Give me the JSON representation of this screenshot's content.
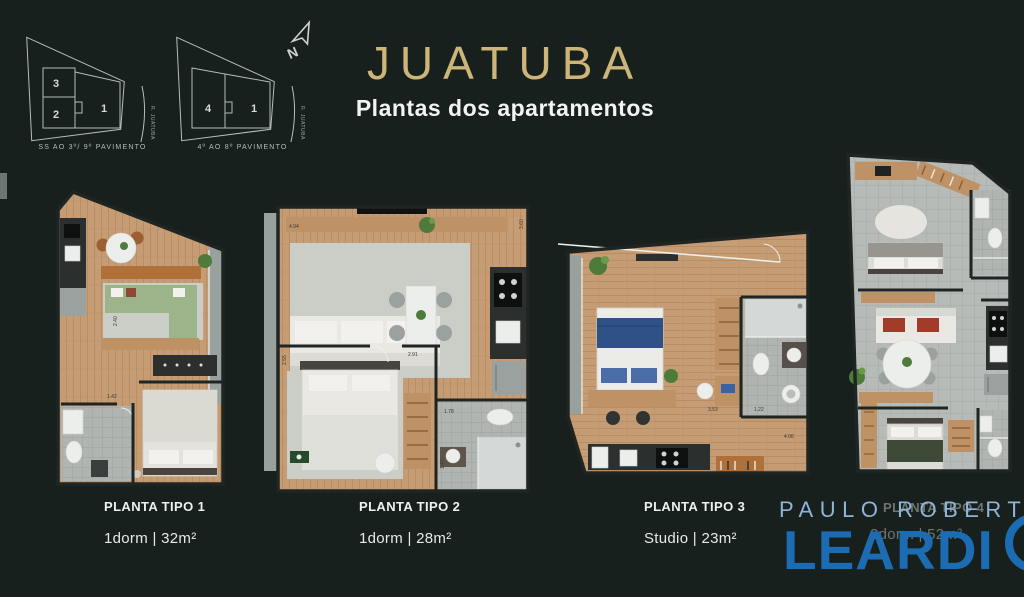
{
  "header": {
    "title": "JUATUBA",
    "subtitle": "Plantas dos apartamentos"
  },
  "north_label": "N",
  "site_plans": [
    {
      "units": [
        "3",
        "2",
        "1"
      ],
      "street": "R. JUATUBA",
      "caption": "SS AO 3º/ 9º PAVIMENTO"
    },
    {
      "units": [
        "4",
        "1"
      ],
      "street": "R. JUATUBA",
      "caption": "4º AO 8º PAVIMENTO"
    }
  ],
  "plans": [
    {
      "name": "PLANTA TIPO 1",
      "spec": "1dorm | 32m²",
      "dims": [
        "2.40",
        "1.42"
      ]
    },
    {
      "name": "PLANTA TIPO 2",
      "spec": "1dorm | 28m²",
      "dims": [
        "4.94",
        "3.60",
        "2.55",
        "2.91",
        "1.78",
        "1.47"
      ]
    },
    {
      "name": "PLANTA TIPO 3",
      "spec": "Studio | 23m²",
      "dims": [
        "3.53",
        "1.22",
        "4.06"
      ]
    },
    {
      "name": "PLANTA TIPO 4",
      "spec": "2dorm | 52m²",
      "dims": []
    }
  ],
  "watermark": {
    "line1": "PAULO ROBERTO",
    "line2": "LEARDI"
  },
  "colors": {
    "background": "#17201d",
    "title_gold": "#cdb479",
    "text_white": "#f2f4f2",
    "watermark_light_blue": "#8fb4d9",
    "watermark_blue": "#1c6cb4",
    "wood_floor": "#c49b72",
    "keyline_gray": "#b6bdba"
  }
}
